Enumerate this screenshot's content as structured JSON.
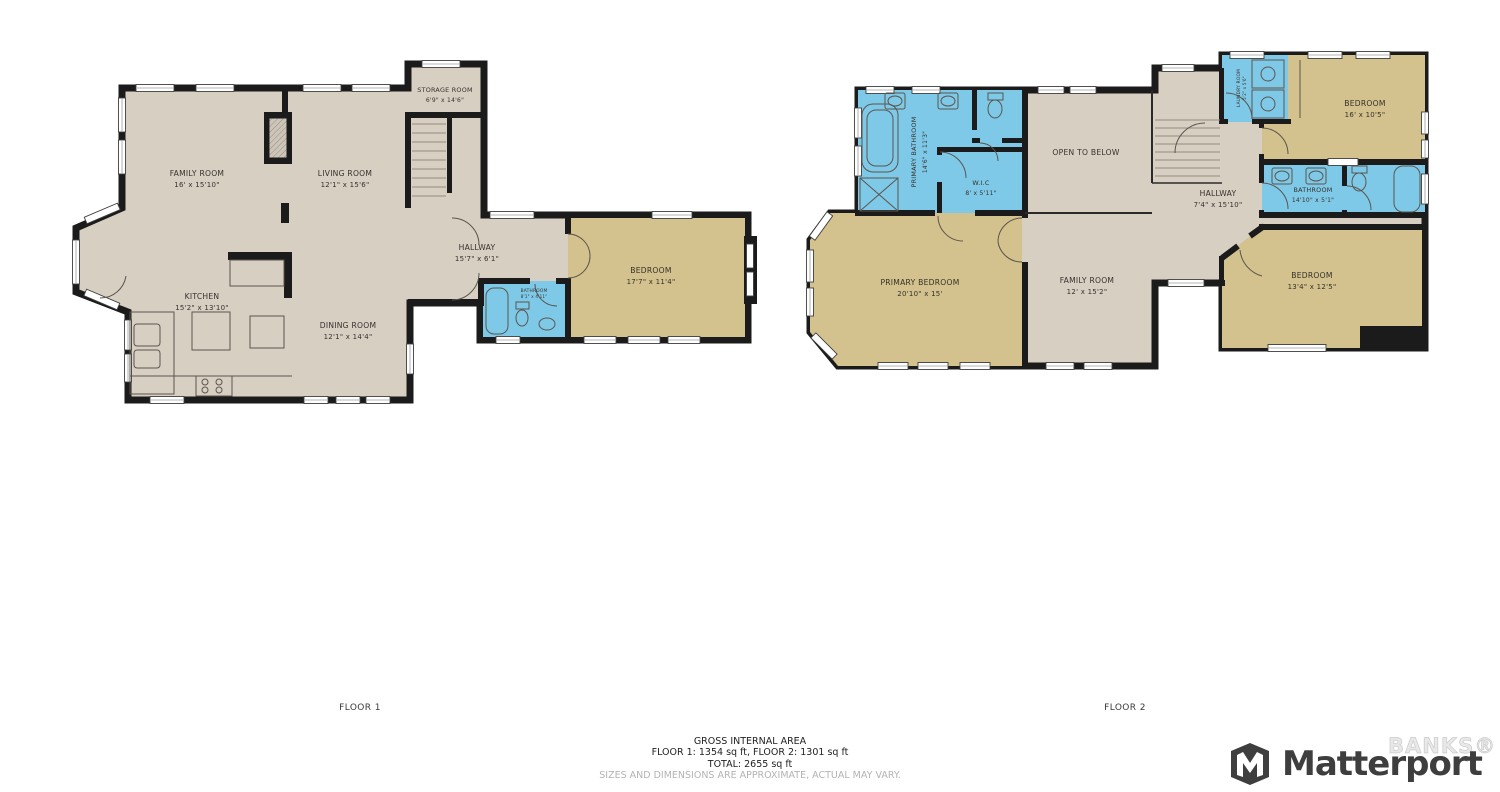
{
  "colors": {
    "wall": "#1b1b1b",
    "floor_common": "#d8cfc3",
    "floor_bedroom": "#d3c28d",
    "floor_wet": "#7fc9e8",
    "label_text": "#35312b",
    "brand_gray": "#3e3e3e"
  },
  "floor1": {
    "label": "FLOOR 1",
    "rooms": {
      "family": {
        "name": "FAMILY ROOM",
        "dims": "16' x 15'10\""
      },
      "living": {
        "name": "LIVING ROOM",
        "dims": "12'1\" x 15'6\""
      },
      "storage": {
        "name": "STORAGE ROOM",
        "dims": "6'9\" x 14'6\""
      },
      "hallway": {
        "name": "HALLWAY",
        "dims": "15'7\" x 6'1\""
      },
      "kitchen": {
        "name": "KITCHEN",
        "dims": "15'2\" x 13'10\""
      },
      "dining": {
        "name": "DINING ROOM",
        "dims": "12'1\" x 14'4\""
      },
      "bedroom": {
        "name": "BEDROOM",
        "dims": "17'7\" x 11'4\""
      },
      "bathroom": {
        "name": "BATHROOM",
        "dims": "8'1\" x 4'11\""
      }
    }
  },
  "floor2": {
    "label": "FLOOR 2",
    "rooms": {
      "primary_bathroom": {
        "name": "PRIMARY BATHROOM",
        "dims": "14'6\" x 11'3\""
      },
      "wic": {
        "name": "W.I.C",
        "dims": "8' x 5'11\""
      },
      "open_below": {
        "name": "OPEN TO BELOW",
        "dims": ""
      },
      "hallway": {
        "name": "HALLWAY",
        "dims": "7'4\" x 15'10\""
      },
      "laundry": {
        "name": "LAUNDRY ROOM",
        "dims": "5'2\" x 5'6\""
      },
      "bedroom_top": {
        "name": "BEDROOM",
        "dims": "16' x 10'5\""
      },
      "bathroom": {
        "name": "BATHROOM",
        "dims": "14'10\" x 5'1\""
      },
      "primary_bedroom": {
        "name": "PRIMARY BEDROOM",
        "dims": "20'10\" x 15'"
      },
      "family": {
        "name": "FAMILY ROOM",
        "dims": "12' x 15'2\""
      },
      "bedroom_bottom": {
        "name": "BEDROOM",
        "dims": "13'4\" x 12'5\""
      }
    }
  },
  "footer": {
    "area_title": "GROSS INTERNAL AREA",
    "area_line1": "FLOOR 1: 1354 sq ft, FLOOR 2: 1301 sq ft",
    "area_line2": "TOTAL: 2655 sq ft",
    "disclaimer": "SIZES AND DIMENSIONS ARE APPROXIMATE, ACTUAL MAY VARY.",
    "brand": "Matterport",
    "brand_icon_letter": "M",
    "watermark": "BANKS®"
  }
}
